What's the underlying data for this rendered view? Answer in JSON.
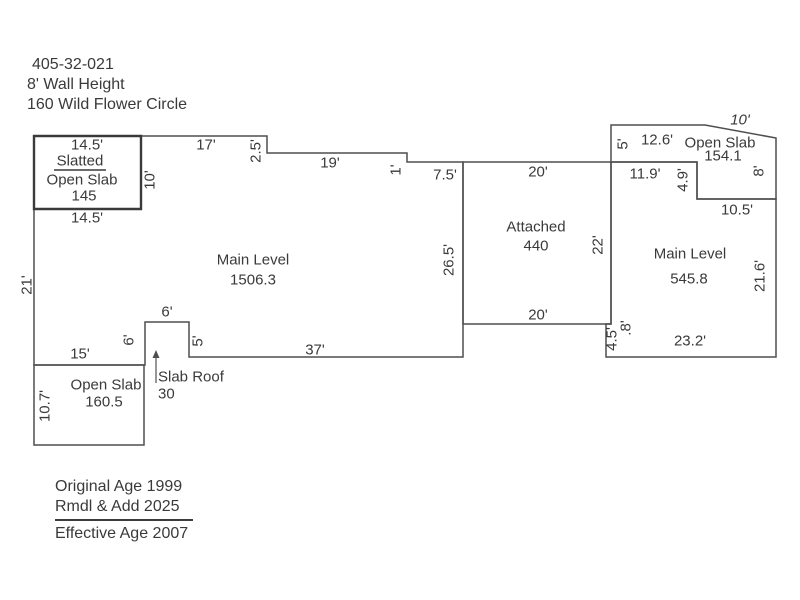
{
  "colors": {
    "background": "#ffffff",
    "line": "#4f4f4f",
    "line_thick": "#3a3a3a",
    "text": "#3a3a3a"
  },
  "header": {
    "lines": [
      "405-32-021",
      "8' Wall Height",
      "160 Wild Flower Circle"
    ]
  },
  "footer": {
    "age_line1": "Original Age 1999",
    "age_line2": "Rmdl & Add 2025",
    "age_line3": "Effective Age 2007"
  },
  "floorplan": {
    "polygons": [
      {
        "name": "main-level-outline",
        "points": [
          [
            34,
            136
          ],
          [
            267,
            136
          ],
          [
            267,
            153
          ],
          [
            407,
            153
          ],
          [
            407,
            162
          ],
          [
            463,
            162
          ],
          [
            463,
            357
          ],
          [
            189,
            357
          ],
          [
            189,
            322
          ],
          [
            145,
            322
          ],
          [
            145,
            365
          ],
          [
            34,
            365
          ]
        ]
      },
      {
        "name": "slatted-open-slab-box",
        "thick": true,
        "points": [
          [
            34,
            136
          ],
          [
            141,
            136
          ],
          [
            141,
            209
          ],
          [
            34,
            209
          ]
        ]
      },
      {
        "name": "open-slab-bottom-left",
        "points": [
          [
            34,
            365
          ],
          [
            144,
            365
          ],
          [
            144,
            445
          ],
          [
            34,
            445
          ]
        ]
      },
      {
        "name": "attached-garage",
        "points": [
          [
            463,
            162
          ],
          [
            611,
            162
          ],
          [
            611,
            324
          ],
          [
            463,
            324
          ]
        ]
      },
      {
        "name": "main-level-right",
        "points": [
          [
            611,
            162
          ],
          [
            697,
            162
          ],
          [
            697,
            199
          ],
          [
            776,
            199
          ],
          [
            776,
            357
          ],
          [
            606,
            357
          ],
          [
            606,
            324
          ],
          [
            611,
            324
          ]
        ]
      },
      {
        "name": "open-slab-top-right",
        "points": [
          [
            611,
            125
          ],
          [
            705,
            125
          ],
          [
            776,
            138
          ],
          [
            776,
            199
          ],
          [
            697,
            199
          ],
          [
            697,
            162
          ],
          [
            611,
            162
          ]
        ]
      }
    ],
    "segments": [
      {
        "name": "slatted-underline",
        "x1": 54,
        "y1": 170,
        "x2": 106,
        "y2": 170
      }
    ],
    "arrow": {
      "name": "slab-roof-arrow",
      "x": 156,
      "y1": 383,
      "y2": 356,
      "head": [
        [
          152.5,
          358
        ],
        [
          156,
          350
        ],
        [
          159.5,
          358
        ]
      ]
    },
    "labels": [
      {
        "name": "dim-14-5-top",
        "text": "14.5'",
        "x": 87,
        "y": 145
      },
      {
        "name": "label-slatted",
        "text": "Slatted",
        "x": 80,
        "y": 161
      },
      {
        "name": "label-open-slab-slatted",
        "text": "Open Slab",
        "x": 82,
        "y": 180
      },
      {
        "name": "area-slatted-145",
        "text": "145",
        "x": 84,
        "y": 196
      },
      {
        "name": "dim-10-slatted",
        "text": "10'",
        "x": 150,
        "y": 180,
        "r": -90
      },
      {
        "name": "dim-14-5-bottom",
        "text": "14.5'",
        "x": 87,
        "y": 218
      },
      {
        "name": "dim-17",
        "text": "17'",
        "x": 206,
        "y": 145
      },
      {
        "name": "dim-2-5",
        "text": "2.5'",
        "x": 256,
        "y": 151,
        "r": -90
      },
      {
        "name": "dim-19",
        "text": "19'",
        "x": 330,
        "y": 163
      },
      {
        "name": "dim-1",
        "text": "1'",
        "x": 396,
        "y": 170,
        "r": -90
      },
      {
        "name": "dim-7-5",
        "text": "7.5'",
        "x": 445,
        "y": 175
      },
      {
        "name": "dim-20-top",
        "text": "20'",
        "x": 538,
        "y": 172
      },
      {
        "name": "dim-5-top-right",
        "text": "5'",
        "x": 623,
        "y": 144,
        "r": -90
      },
      {
        "name": "dim-12-6",
        "text": "12.6'",
        "x": 657,
        "y": 140
      },
      {
        "name": "label-open-slab-top-right",
        "text": "Open Slab",
        "x": 720,
        "y": 143
      },
      {
        "name": "area-open-slab-154-1",
        "text": "154.1",
        "x": 723,
        "y": 156
      },
      {
        "name": "dim-10-slant",
        "text": "10'",
        "x": 740,
        "y": 120,
        "italic": true
      },
      {
        "name": "dim-8",
        "text": "8'",
        "x": 759,
        "y": 171,
        "r": -90
      },
      {
        "name": "dim-11-9",
        "text": "11.9'",
        "x": 645,
        "y": 174
      },
      {
        "name": "dim-4-9",
        "text": "4.9'",
        "x": 683,
        "y": 180,
        "r": -90
      },
      {
        "name": "dim-10-5",
        "text": "10.5'",
        "x": 737,
        "y": 210
      },
      {
        "name": "label-main-level-right",
        "text": "Main Level",
        "x": 690,
        "y": 254
      },
      {
        "name": "area-main-right-545-8",
        "text": "545.8",
        "x": 689,
        "y": 279
      },
      {
        "name": "dim-21-6",
        "text": "21.6'",
        "x": 760,
        "y": 276,
        "r": -90
      },
      {
        "name": "label-attached",
        "text": "Attached",
        "x": 536,
        "y": 227
      },
      {
        "name": "area-attached-440",
        "text": "440",
        "x": 536,
        "y": 246
      },
      {
        "name": "dim-22",
        "text": "22'",
        "x": 598,
        "y": 245,
        "r": -90
      },
      {
        "name": "dim-26-5",
        "text": "26.5'",
        "x": 449,
        "y": 260,
        "r": -90
      },
      {
        "name": "label-main-level-left",
        "text": "Main Level",
        "x": 253,
        "y": 260
      },
      {
        "name": "area-main-left-1506-3",
        "text": "1506.3",
        "x": 253,
        "y": 280
      },
      {
        "name": "dim-21",
        "text": "21'",
        "x": 27,
        "y": 285,
        "r": -90
      },
      {
        "name": "dim-20-bottom",
        "text": "20'",
        "x": 538,
        "y": 315
      },
      {
        "name": "dim-0-8",
        "text": ".8'",
        "x": 626,
        "y": 328,
        "r": -90
      },
      {
        "name": "dim-4-5",
        "text": "4.5'",
        "x": 612,
        "y": 339,
        "r": -90
      },
      {
        "name": "dim-23-2",
        "text": "23.2'",
        "x": 690,
        "y": 341
      },
      {
        "name": "dim-37",
        "text": "37'",
        "x": 315,
        "y": 350
      },
      {
        "name": "dim-15",
        "text": "15'",
        "x": 80,
        "y": 354
      },
      {
        "name": "dim-6-top",
        "text": "6'",
        "x": 167,
        "y": 312
      },
      {
        "name": "dim-6-left",
        "text": "6'",
        "x": 129,
        "y": 340,
        "r": -90
      },
      {
        "name": "dim-5-bump",
        "text": "5'",
        "x": 198,
        "y": 341,
        "r": -90
      },
      {
        "name": "label-open-slab-bottom-left",
        "text": "Open Slab",
        "x": 106,
        "y": 385
      },
      {
        "name": "area-open-slab-160-5",
        "text": "160.5",
        "x": 104,
        "y": 402
      },
      {
        "name": "dim-10-7",
        "text": "10.7'",
        "x": 45,
        "y": 406,
        "r": -90
      },
      {
        "name": "label-slab-roof",
        "text": "Slab Roof",
        "x": 158,
        "y": 377,
        "anchor": "start"
      },
      {
        "name": "area-slab-roof-30",
        "text": "30",
        "x": 158,
        "y": 394,
        "anchor": "start"
      }
    ]
  }
}
